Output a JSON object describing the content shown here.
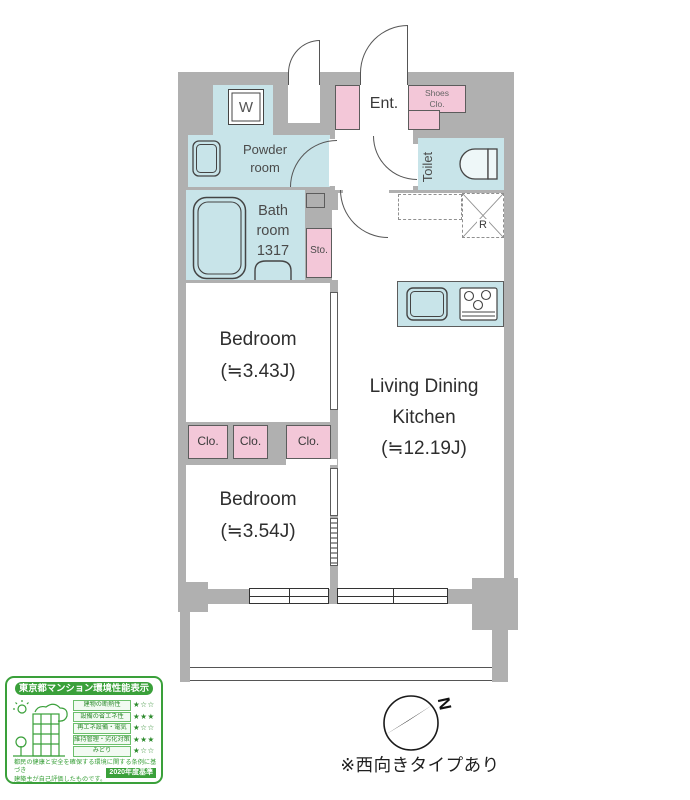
{
  "rooms": {
    "washer": "W",
    "entrance": "Ent.",
    "shoes_closet": "Shoes\nClo.",
    "powder_room": "Powder\nroom",
    "toilet": "Toilet",
    "bathroom": "Bath\nroom\n1317",
    "storage": "Sto.",
    "bedroom1": "Bedroom\n(≒3.43J)",
    "bedroom2": "Bedroom\n(≒3.54J)",
    "ldk": "Living Dining\nKitchen\n(≒12.19J)",
    "closet": "Clo.",
    "refrigerator": "R"
  },
  "compass": {
    "north": "N"
  },
  "note": "※西向きタイプあり",
  "eco_label": {
    "title": "東京都マンション環境性能表示",
    "rows": [
      {
        "label": "建物の断熱性",
        "stars": "★☆☆"
      },
      {
        "label": "設備の省エネ性",
        "stars": "★★★"
      },
      {
        "label": "再エネ設備・電気",
        "stars": "★☆☆"
      },
      {
        "label": "維持管理・劣化対策",
        "stars": "★★★"
      },
      {
        "label": "みどり",
        "stars": "★☆☆"
      }
    ],
    "footnote": "都民の健康と安全を確保する環境に関する条例に基づき\n建築主が自己評価したものです。",
    "standard": "2020年度基準"
  },
  "colors": {
    "wall_gray": "#b0b0b0",
    "room_blue": "#c8e4e9",
    "accent_pink": "#f3c7d8",
    "eco_green": "#3aa03a"
  }
}
